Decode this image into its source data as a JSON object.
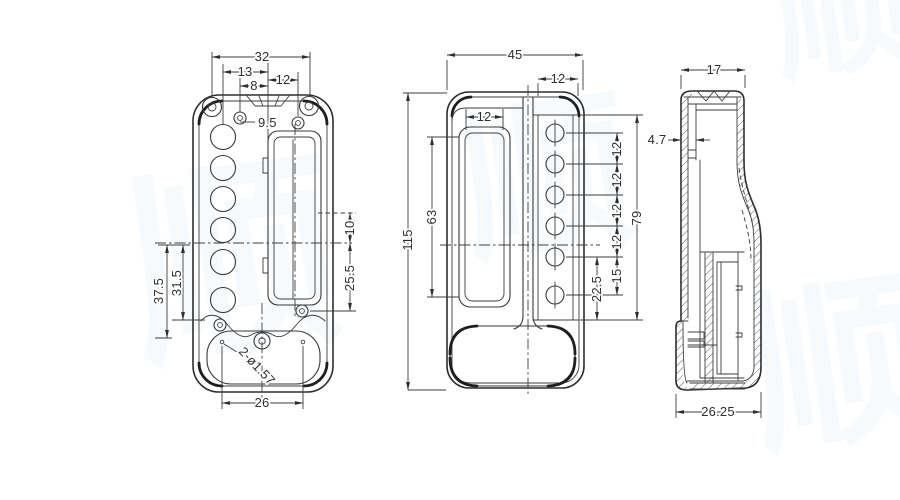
{
  "colors": {
    "background": "#ffffff",
    "line": "#2e2e2e",
    "dim_text": "#2e2e2e",
    "watermark": "#f7fafd"
  },
  "watermark_chars": [
    "顺",
    "顺",
    "顺",
    "顺"
  ],
  "front_view": {
    "dim_total_width": "32",
    "dim_13": "13",
    "dim_8": "8",
    "dim_12": "12",
    "dim_9_5": "9.5",
    "dim_10": "10",
    "dim_25_5": "25.5",
    "dim_37_5": "37.5",
    "dim_31_5": "31.5",
    "dim_bottom_holes": "2-ø1.57",
    "dim_26": "26"
  },
  "center_view": {
    "dim_45": "45",
    "dim_12_top": "12",
    "dim_12_slot": "12",
    "dim_63": "63",
    "dim_115": "115",
    "dim_12_a": "12",
    "dim_12_b": "12",
    "dim_12_c": "12",
    "dim_12_d": "12",
    "dim_15": "15",
    "dim_22_5": "22.5",
    "dim_79": "79"
  },
  "side_view": {
    "dim_17": "17",
    "dim_4_7": "4.7",
    "dim_26_25": "26.25"
  }
}
